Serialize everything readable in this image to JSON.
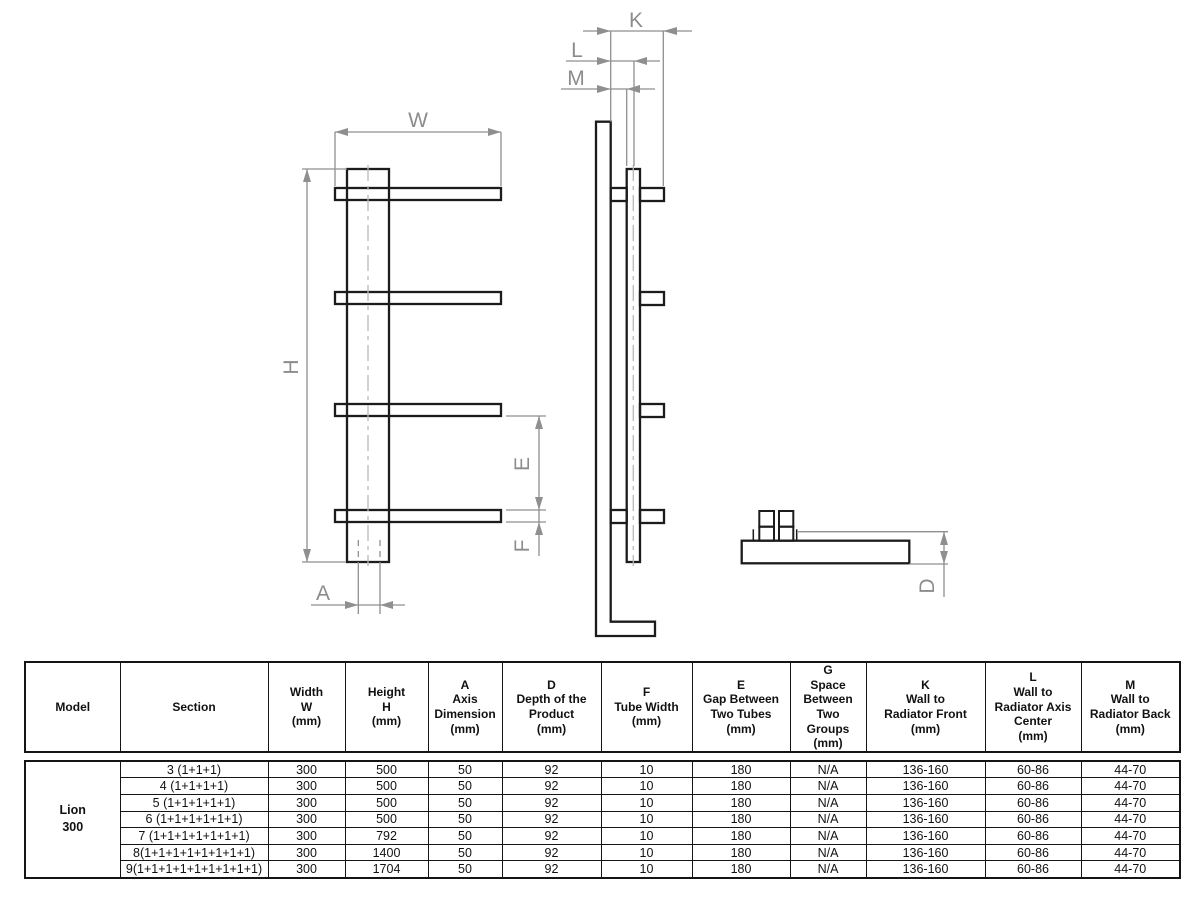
{
  "drawing": {
    "labels": {
      "w": "W",
      "h": "H",
      "a": "A",
      "e": "E",
      "f": "F",
      "k": "K",
      "l": "L",
      "m": "M",
      "d": "D"
    }
  },
  "table": {
    "headers": [
      "Model",
      "Section",
      "Width\nW\n(mm)",
      "Height\nH\n(mm)",
      "A\nAxis\nDimension\n(mm)",
      "D\nDepth of the\nProduct\n(mm)",
      "F\nTube Width\n(mm)",
      "E\nGap Between\nTwo Tubes\n(mm)",
      "G\nSpace\nBetween Two\nGroups\n(mm)",
      "K\nWall to\nRadiator Front\n(mm)",
      "L\nWall to\nRadiator Axis\nCenter\n(mm)",
      "M\nWall to\nRadiator Back\n(mm)"
    ],
    "model": "Lion\n300",
    "rows": [
      {
        "section": "3 (1+1+1)",
        "width": "300",
        "height": "500",
        "a": "50",
        "d": "92",
        "f": "10",
        "e": "180",
        "g": "N/A",
        "k": "136-160",
        "l": "60-86",
        "m": "44-70"
      },
      {
        "section": "4 (1+1+1+1)",
        "width": "300",
        "height": "500",
        "a": "50",
        "d": "92",
        "f": "10",
        "e": "180",
        "g": "N/A",
        "k": "136-160",
        "l": "60-86",
        "m": "44-70"
      },
      {
        "section": "5 (1+1+1+1+1)",
        "width": "300",
        "height": "500",
        "a": "50",
        "d": "92",
        "f": "10",
        "e": "180",
        "g": "N/A",
        "k": "136-160",
        "l": "60-86",
        "m": "44-70"
      },
      {
        "section": "6 (1+1+1+1+1+1)",
        "width": "300",
        "height": "500",
        "a": "50",
        "d": "92",
        "f": "10",
        "e": "180",
        "g": "N/A",
        "k": "136-160",
        "l": "60-86",
        "m": "44-70"
      },
      {
        "section": "7 (1+1+1+1+1+1+1)",
        "width": "300",
        "height": "792",
        "a": "50",
        "d": "92",
        "f": "10",
        "e": "180",
        "g": "N/A",
        "k": "136-160",
        "l": "60-86",
        "m": "44-70"
      },
      {
        "section": "8(1+1+1+1+1+1+1+1)",
        "width": "300",
        "height": "1400",
        "a": "50",
        "d": "92",
        "f": "10",
        "e": "180",
        "g": "N/A",
        "k": "136-160",
        "l": "60-86",
        "m": "44-70"
      },
      {
        "section": "9(1+1+1+1+1+1+1+1+1)",
        "width": "300",
        "height": "1704",
        "a": "50",
        "d": "92",
        "f": "10",
        "e": "180",
        "g": "N/A",
        "k": "136-160",
        "l": "60-86",
        "m": "44-70"
      }
    ]
  }
}
